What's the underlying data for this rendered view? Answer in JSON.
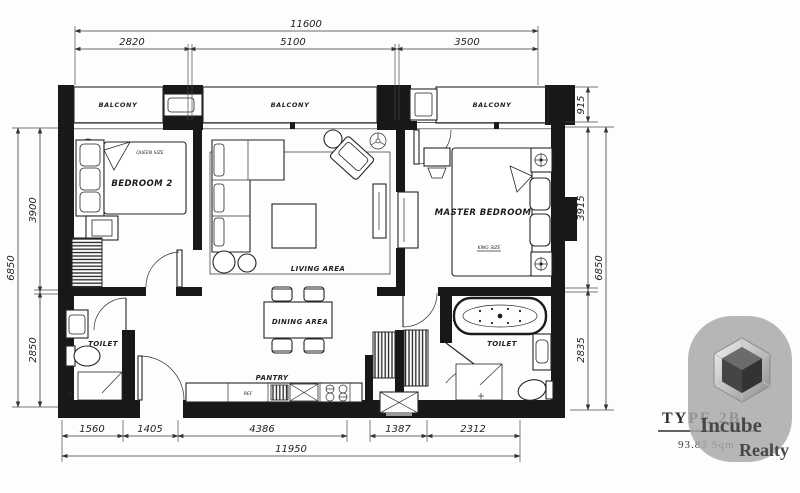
{
  "plan": {
    "rooms": {
      "balcony_left": "BALCONY",
      "balcony_center": "BALCONY",
      "balcony_right": "BALCONY",
      "bedroom2": "BEDROOM 2",
      "bedroom2_bed_size": "QUEEN SIZE",
      "living": "LIVING AREA",
      "dining": "DINING AREA",
      "pantry": "PANTRY",
      "master_bedroom": "MASTER BEDROOM",
      "master_bed_size": "KING SIZE",
      "toilet_common": "TOILET",
      "toilet_master": "TOILET",
      "fridge": "REF"
    },
    "dimensions": {
      "top_total": "11600",
      "top_left": "2820",
      "top_mid": "5100",
      "top_right": "3500",
      "left_upper": "3900",
      "left_lower": "2850",
      "left_total": "6850",
      "right_balcony": "915",
      "right_upper": "3915",
      "right_lower": "2835",
      "right_total": "6850",
      "bottom_1": "1560",
      "bottom_2": "1405",
      "bottom_3": "4386",
      "bottom_4": "1387",
      "bottom_5": "2312",
      "bottom_total": "11950"
    }
  },
  "overlay": {
    "plan_type": "TYPE 2B",
    "plan_area": "93.83 Sqm",
    "brand_line1": "Incube",
    "brand_line2": "Realty",
    "blob_color": "#a8a8a8"
  }
}
